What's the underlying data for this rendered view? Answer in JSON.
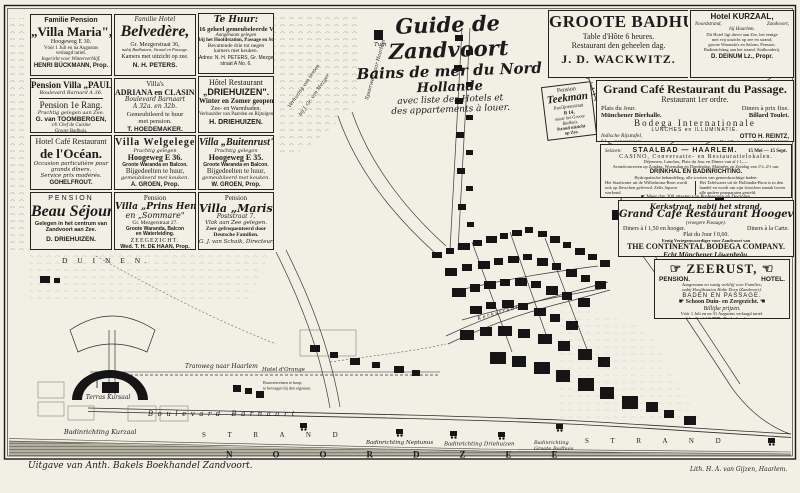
{
  "colors": {
    "paper": "#f2efe5",
    "ink": "#1b1b1b",
    "sea_band": "#b7b2a4",
    "sea_line": "#5d594e"
  },
  "title": {
    "t1": "Guide de Zandvoort",
    "t2": "Bains de mer du Nord",
    "t3": "Hollande",
    "t4": "avec liste des Hotels et",
    "t5": "des appartements à louer."
  },
  "ads": {
    "villa_maria": {
      "h": "Familie Pension",
      "t": "„Villa Maria\",",
      "a": "Hoogeweg E 30.",
      "n1": "Vóór 1 Juli en na Augustus",
      "n2": "verlaagd tarief.",
      "n3": "Ingericht voor Winterverblijf.",
      "p": "HENRI BÜCKMANN, Prop."
    },
    "belvedere": {
      "h": "Familie Hotel",
      "t": "Belvedère,",
      "a": "Gr. Mezgerstraat 36,",
      "n1": "nabij Badhuizen, Strand en Passage.",
      "n2": "Kamers met uitzicht op zee.",
      "p": "N. H. PETERS."
    },
    "te_huur": {
      "h": "Te Huur:",
      "t": "16 geheel gemeubeleerde Villa's,",
      "n1": "Aangenaam gelegen",
      "n2": "bij het Hoofdstation, Passage en Strand.",
      "n3": "Bevattende drie tot negen",
      "n4": "kamers met keuken.",
      "p": "Adres: N. H. PETERS, Gr. Mezger-",
      "p2": "straat A No. 6."
    },
    "paula": {
      "t": "Pension Villa „PAULA\",",
      "a": "Boulevard Barnard A 36.",
      "r": "Pension 1e Rang.",
      "n1": "Prachtig gelegen aan Zee.",
      "p": "G. van TOOMBERGEN,",
      "p2": "v/h Chef de Cuisine",
      "p3": "Groote Badhuis."
    },
    "adriana": {
      "h": "Villa's",
      "t": "ADRIANA en CLASINA",
      "a": "Boulevard Barnaart",
      "a2": "A 32a. en 32b.",
      "n1": "Gemeubileerd te huur",
      "n2": "met pension.",
      "p": "T. HOEDEMAKER."
    },
    "driehuizen_hotel": {
      "h": "Hôtel Restaurant",
      "t": "„DRIEHUIZEN\".",
      "n1": "Winter en Zomer geopend.",
      "n2": "Zee- en Warmbaden.",
      "n3": "Verhuurder van Paarden en Rijtuigen.",
      "p": "H. DRIEHUIZEN."
    },
    "ocean": {
      "h": "Hotel Café Restaurant",
      "t": "de l'Océan.",
      "n1": "Occasion particulière pour",
      "n2": "grands dîners.",
      "n3": "Service prix modérés.",
      "p": "GOHELFROUT."
    },
    "welgelegen": {
      "t": "Villa Welgelegen",
      "n1": "Prachtig gelegen",
      "a": "Hoogeweg E 36.",
      "n2": "Groote Waranda en Balcon.",
      "n3": "Bijgedeelten te huur,",
      "n4": "gemeubileerd met keuken.",
      "p": "A. GROEN, Prop."
    },
    "buitenrust": {
      "t": "Villa „Buitenrust\"",
      "n1": "Prachtig gelegen",
      "a": "Hoogeweg E 35.",
      "n2": "Groote Waranda en Balcon.",
      "n3": "Bijgedeelten te huur,",
      "n4": "gemeubileerd met keuken.",
      "p": "W. GROEN, Prop."
    },
    "beau_sejour": {
      "h": "PENSION",
      "t": "Beau Séjour",
      "n1": "Gelegen in het centrum van",
      "n2": "Zandvoort aan Zee.",
      "p": "D. DRIEHUIZEN."
    },
    "prins_hendrik": {
      "h": "Pension",
      "t": "Villa „Prins Hendrik\"",
      "t2": "en „Sommare\"",
      "a": "Gr. Mezgerstraat 27.",
      "n1": "Groote Waranda, Balcon",
      "n2": "en Waterleiding.",
      "n3": "ZEEGEZICHT.",
      "p": "Wed. T. H. DE HAAN, Prop."
    },
    "maris": {
      "h": "Pension",
      "t": "Villa „Maris\"",
      "a": "Poststraat 7.",
      "n1": "Vlak aan Zee gelegen.",
      "n2": "Zeer gefrequenteerd door",
      "n3": "Deutsche Familien.",
      "p": "G. J. van Schaik, Directeur."
    },
    "groote_badhuis": {
      "t": "GROOTE BADHUIS.",
      "n1": "Table d'Hôte 6 heures.",
      "n2": "Restaurant den geheelen dag.",
      "p": "J. D. WACKWITZ."
    },
    "kurzaal": {
      "t": "Hotel KURZAAL,",
      "a": "Noordstrand,",
      "a2": "Zandvoort,",
      "a3": "bij Haarlem.",
      "f1": "Dit Hotel ligt direct aan Zee, het eenige",
      "f2": "met vrij uitzicht op zee en strand;",
      "f3": "groote Waranda's en Salons; Pension.",
      "f4": "Badinrichting aan het strand. Stalhouderij.",
      "p": "D. DEINUM Lz., Propr."
    },
    "teekman": {
      "h": "Pension",
      "t": "Teekman",
      "a": "Paviljoenstraat",
      "a2": "B 14,",
      "n1": "naast het Groote",
      "n2": "Badhuis.",
      "n3": "Strand uitzicht",
      "n4": "op Zee."
    },
    "passage": {
      "t": "Grand Café Restaurant du Passage.",
      "s": "Restaurant 1er ordre.",
      "r1a": "Plats du Jour.",
      "r1b": "Diners à prix fixe.",
      "r2a": "Münchener Bierhalle.",
      "r2b": "Billard Toulet.",
      "b": "Bodega Internationale",
      "b2": "LUNCHES en ILLUMINATIE.",
      "n1": "Indische Rijsttafel,",
      "n2": "f 1.— per persoon.",
      "p": "OTTO H. REINTZ,",
      "p2": "Hotel Restaurant „ZUM KURHAUS\",",
      "p3": "Wereldtentoonstelling 1883, Amsterdam."
    },
    "staalbad": {
      "pre": "Seizoen:",
      "t": "STAALBAD — HAARLEM.",
      "dates": "15 Mei — 15 Sept.",
      "l1": "CASINO, Conversatie- en Restauratielokalen.",
      "f1": "Déjeuners, Lunches, Plats du Jour en Diners van af f 1,—.",
      "f2": "Avondconcerten op Zondag, Woensdag en Donderdag; Matinées op Zondag van 1½–2½ uur.",
      "l2": "DRINKHAL EN BADINRICHTING.",
      "f3": "Hydropatische behandeling, alle soorten van geneeskrachtige baden.",
      "cA": "Het Staalwater uit de Wilhelmina-Bron wordt ook op flesschen geleverd. Zelfs liqueur werkend.",
      "cB": "Het Tafelwater uit de Hollandia-Bron is in den handel en wordt om zijn frisschen smaak boven alle andere praeparaten gesteld.",
      "f4": "☛ Meer dan 300 attesten van Professoren en Doctoren.",
      "f5": "Honorair Medisch Adviseur Prof. Dr. B. J. STOKVIS, te Amsterdam."
    },
    "hoogeveld": {
      "h": "Kerkstraat, nabij het strand.",
      "t": "Grand Café Restaurant Hoogeveld",
      "t2": "(vroegere Passage).",
      "c1": "Diners à f 1,50 en hooger.",
      "c2": "Diners à la Carte.",
      "n1": "Plat du Jour f 0,60.",
      "f1": "Eenig Vertegenwoordiger voor Zandvoort van",
      "b": "THE CONTINENTAL BODEGA COMPANY.",
      "b2": "Echt Münchener Löwenbräu.",
      "f2": "Aan het Café Restaurant is verbonden een groote Tuin, welke des avonds schitterend is",
      "f3": "verlicht, alwaar gedurende het Badseizoen afwisselend Concerten worden gegeven."
    },
    "zeerust": {
      "t": "☞ ZEERUST, ☜",
      "c1": "PENSION.",
      "c2": "HOTEL.",
      "f1": "Aangenaam en rustig verblijf voor Families;",
      "f2": "nabij Hoofdstation Halte Dorp (Zandvoort).",
      "l1": "BADEN EN PASSAGE.",
      "l2": "☛ Schoon Duin- en Zeegezicht. ☚",
      "l3": "Billijke prijzen.",
      "f3": "Vóór 1 Juli en na 31 Augustus verlaagd tarief.",
      "p": "H. C. VOET, Driehuizen."
    }
  },
  "map": {
    "duinen": "D U I N E N.",
    "tuin": "Tuin",
    "spoorweg": "Spoorweg naar Haarlem",
    "tents1": "Verhuring van tenten",
    "tents2": "bij J. Gr. van Mezger",
    "tram": "Tramweg naar Haarlem",
    "kerkstraat": "K e r k s t r a a t",
    "hotel_orange": "Hotel d'Orange",
    "bouw1": "Bouwterreinen te koop,",
    "bouw2": "te bevragen bij den eigenaar.",
    "terras": "Terras Kursaal",
    "boulevard": "Boulevard    Barnaart",
    "bad_kurzaal": "Badinrichting Kurzaal",
    "strand": "S T R A N D",
    "bad_neptunus": "Badinrichting Neptunus",
    "bad_driehuizen": "Badinrichting Driehuizen",
    "bad_groote1": "Badinrichting",
    "bad_groote2": "Groote Badhuis",
    "noordzee": "NOORDZEE"
  },
  "credits": {
    "left": "Uitgave van Anth. Bakels Boekhandel Zandvoort.",
    "right": "Lith. H. A. van Gijzen, Haarlem."
  }
}
